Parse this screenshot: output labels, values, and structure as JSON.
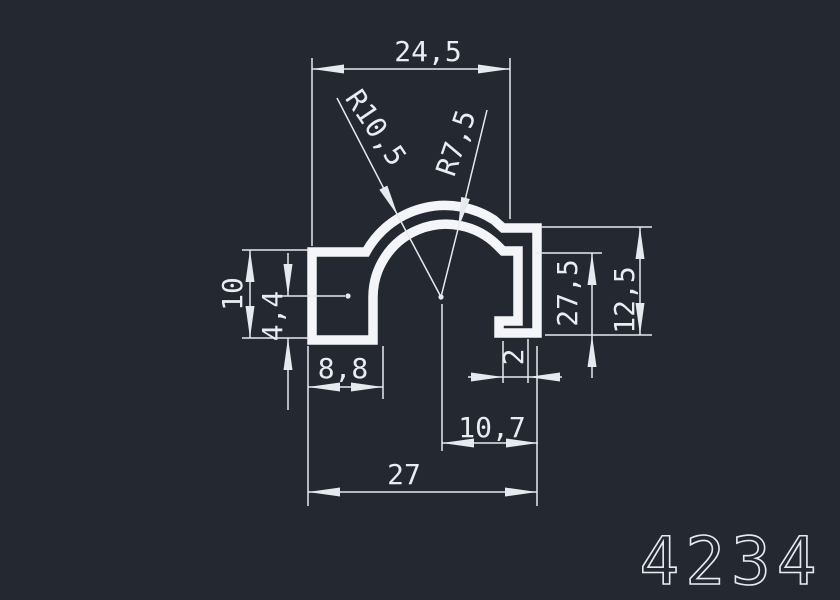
{
  "canvas": {
    "background": "#242831",
    "line_color": "#e6eaef",
    "profile_color": "#f3f5f8"
  },
  "part_number": "4234",
  "dims": {
    "top_width": "24,5",
    "radius_outer": "R10,5",
    "radius_inner": "R7,5",
    "flange_height": "10",
    "flange_inner_height": "4,4",
    "flange_width": "8,8",
    "right_inner_height": "27,5",
    "right_height": "12,5",
    "lip_thickness": "2",
    "center_to_right": "10,7",
    "total_width": "27"
  }
}
